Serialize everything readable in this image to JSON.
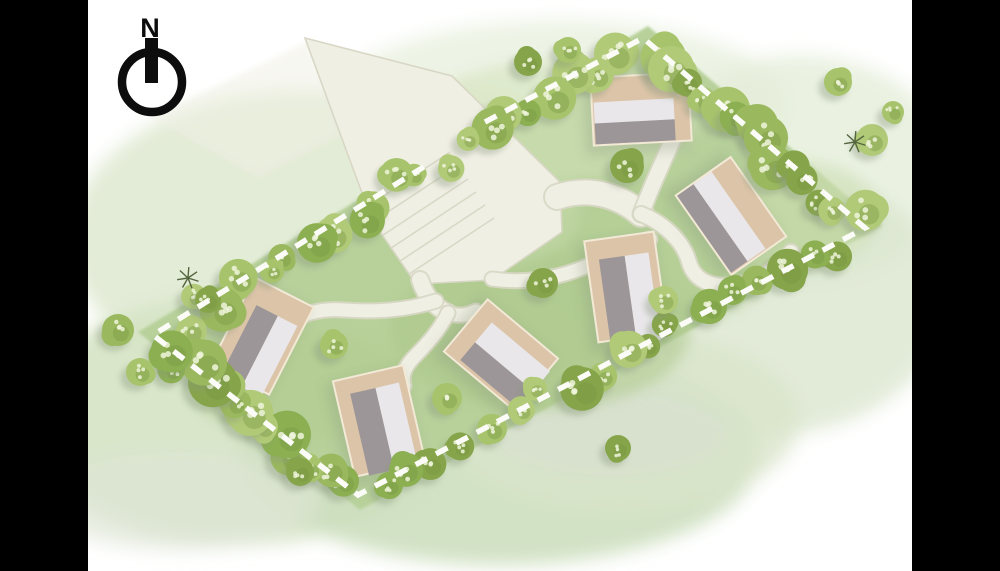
{
  "palette": {
    "letterbox": "#000000",
    "background": "#ffffff",
    "lawn": "#b8d19b",
    "road_fill": "#f0efe4",
    "road_edge": "#d8d7c5",
    "boundary_dash": "#fbfcf7",
    "plot_beige": "#dcc4a8",
    "plot_border": "#f2e9d6",
    "roof_light": "#e9e7ea",
    "roof_dark": "#9d9699",
    "tree_greens": [
      "#9ab85e",
      "#a7c46c",
      "#8caf52",
      "#b1ca77",
      "#86a54b"
    ],
    "tree_speckle": "#eef5da",
    "tree_blotch": "#74923f",
    "shadow": "#87977c",
    "bare_tree": "#55663f",
    "compass_ink": "#0d0d0d",
    "parking_line": "#d9d8c6"
  },
  "compass": {
    "label": "N"
  },
  "site_plan": {
    "boundary_dash_path": "M485,122 L643,38 L865,228 L358,495 L153,335 L430,163",
    "lawn_points": "648,26 882,226 360,510 138,332",
    "houses": [
      {
        "id": "plot-1",
        "cx": 641,
        "cy": 109,
        "w": 98,
        "h": 68,
        "rot": -3,
        "roof": [
          [
            "light",
            2,
            25,
            80,
            22
          ],
          [
            "dark",
            2,
            46,
            80,
            21
          ]
        ]
      },
      {
        "id": "plot-2",
        "cx": 731,
        "cy": 216,
        "w": 97,
        "h": 67,
        "rot": 55,
        "roof": [
          [
            "light",
            1,
            24,
            94,
            22
          ],
          [
            "dark",
            1,
            46,
            94,
            20
          ]
        ]
      },
      {
        "id": "plot-3",
        "cx": 626,
        "cy": 287,
        "w": 70,
        "h": 102,
        "rot": -8,
        "roof": [
          [
            "dark",
            12,
            20,
            26,
            84
          ],
          [
            "light",
            38,
            20,
            24,
            88
          ]
        ]
      },
      {
        "id": "plot-4",
        "cx": 501,
        "cy": 355,
        "w": 92,
        "h": 68,
        "rot": 40,
        "roof": [
          [
            "light",
            18,
            15,
            76,
            26
          ],
          [
            "dark",
            18,
            41,
            80,
            23
          ]
        ]
      },
      {
        "id": "plot-5",
        "cx": 262,
        "cy": 336,
        "w": 66,
        "h": 98,
        "rot": 27,
        "roof": [
          [
            "dark",
            14,
            24,
            24,
            76
          ],
          [
            "light",
            38,
            24,
            22,
            80
          ]
        ]
      },
      {
        "id": "plot-6",
        "cx": 379,
        "cy": 421,
        "w": 72,
        "h": 98,
        "rot": -13,
        "roof": [
          [
            "dark",
            14,
            16,
            26,
            84
          ],
          [
            "light",
            40,
            16,
            24,
            88
          ]
        ]
      }
    ],
    "roads": {
      "plaza_points": "305,38 452,76 560,182 562,232 492,280 416,284 372,220 338,128",
      "faded_entry_points": "310,40 152,118 258,178 344,134",
      "paths": [
        {
          "name": "path-to-junction",
          "d": "M557,197 C590,186 620,196 641,214",
          "w": 24
        },
        {
          "name": "path-house-a",
          "d": "M641,214 C650,190 660,168 669,148 C679,127 686,104 689,78",
          "w": 15
        },
        {
          "name": "path-house-b-loop",
          "d": "M641,214 C666,224 684,243 689,262 C695,283 716,289 741,284 C763,279 780,266 791,252",
          "w": 14
        },
        {
          "name": "path-house-c",
          "d": "M492,279 C528,284 562,278 594,263 C614,253 634,243 650,239",
          "w": 13
        },
        {
          "name": "path-plaza-south",
          "d": "M420,280 C426,297 434,307 448,313",
          "w": 16
        },
        {
          "name": "path-house-d",
          "d": "M448,313 C460,317 468,315 476,311",
          "w": 13
        },
        {
          "name": "path-house-f",
          "d": "M448,313 C439,331 427,344 416,355 C405,366 401,375 404,386",
          "w": 13
        },
        {
          "name": "path-house-e",
          "d": "M436,301 C404,311 374,312 344,310 C320,308 302,314 288,323",
          "w": 13
        }
      ],
      "parking_lines": [
        [
          350,
          218,
          450,
          152
        ],
        [
          359,
          231,
          459,
          165
        ],
        [
          368,
          245,
          468,
          179
        ],
        [
          376,
          258,
          476,
          192
        ],
        [
          385,
          271,
          485,
          205
        ],
        [
          394,
          284,
          494,
          218
        ]
      ]
    },
    "washes": [
      [
        560,
        105,
        230,
        85,
        "#eaf1e0",
        0.85
      ],
      [
        800,
        170,
        150,
        115,
        "#e5eed9",
        0.8
      ],
      [
        770,
        300,
        175,
        135,
        "#dde8d1",
        0.85
      ],
      [
        300,
        240,
        230,
        150,
        "#e0ead3",
        0.9
      ],
      [
        420,
        180,
        170,
        95,
        "#e3ecd6",
        0.75
      ],
      [
        240,
        420,
        215,
        125,
        "#d5e3c4",
        0.9
      ],
      [
        500,
        455,
        260,
        110,
        "#cddfbf",
        0.9
      ],
      [
        620,
        420,
        180,
        90,
        "#d9e5cb",
        0.8
      ],
      [
        180,
        500,
        140,
        50,
        "#dee6d6",
        0.7
      ],
      [
        610,
        432,
        120,
        45,
        "#d8dfd2",
        0.6
      ]
    ],
    "lawn_patches": [
      [
        540,
        330,
        150,
        80,
        "#a9c588",
        0.5
      ],
      [
        660,
        255,
        120,
        70,
        "#b2cc92",
        0.45
      ],
      [
        300,
        385,
        110,
        55,
        "#aeca8d",
        0.4
      ],
      [
        560,
        120,
        140,
        60,
        "#d3e2ba",
        0.55
      ],
      [
        795,
        215,
        85,
        55,
        "#cfe0b4",
        0.5
      ],
      [
        480,
        210,
        100,
        60,
        "#c8dcae",
        0.45
      ]
    ],
    "vegetation": {
      "belts": [
        {
          "name": "northwest",
          "from": [
            628,
            44
          ],
          "to": [
            168,
            328
          ],
          "count": 21,
          "rmin": 11,
          "rmax": 23,
          "spread": 15
        },
        {
          "name": "northeast",
          "from": [
            658,
            48
          ],
          "to": [
            860,
            220
          ],
          "count": 14,
          "rmin": 12,
          "rmax": 24,
          "spread": 17
        },
        {
          "name": "southeast",
          "from": [
            852,
            240
          ],
          "to": [
            370,
            490
          ],
          "count": 18,
          "rmin": 10,
          "rmax": 22,
          "spread": 14
        },
        {
          "name": "southwest",
          "from": [
            346,
            490
          ],
          "to": [
            162,
            344
          ],
          "count": 13,
          "rmin": 13,
          "rmax": 25,
          "spread": 16
        }
      ],
      "single_trees": [
        [
          627,
          166,
          17
        ],
        [
          543,
          283,
          15
        ],
        [
          334,
          345,
          14
        ],
        [
          447,
          398,
          15
        ],
        [
          664,
          300,
          14
        ],
        [
          872,
          140,
          16
        ],
        [
          893,
          112,
          11
        ],
        [
          838,
          82,
          14
        ],
        [
          118,
          330,
          16
        ],
        [
          140,
          372,
          14
        ],
        [
          208,
          300,
          13
        ],
        [
          528,
          62,
          14
        ],
        [
          568,
          50,
          13
        ],
        [
          618,
          448,
          13
        ],
        [
          300,
          472,
          14
        ]
      ],
      "bare_trees": [
        [
          855,
          142
        ],
        [
          188,
          278
        ]
      ]
    }
  }
}
